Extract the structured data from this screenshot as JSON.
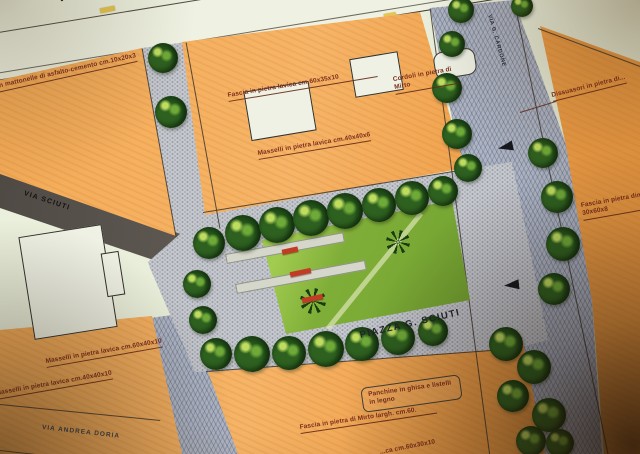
{
  "title": {
    "piazza": "PIAZZA G. SCIUTI"
  },
  "streets": {
    "top": "VIA F.",
    "left": "VIA SCIUTI",
    "bottom_left": "VIA ANDREA DORIA",
    "right_vertical": "VIA G. CARDONE"
  },
  "annotations": {
    "asfalto": "con mattonelle di asfalto-cemento cm.10x20x3",
    "fascia_lavica_top": "Fascia in pietra lavica cm.60x35x10",
    "cordoli_mirto": "Cordoli in pietra di Mirto",
    "masselli_40x40x6": "Masselli in pietra lavica cm.40x40x6",
    "dissuasori": "Dissuasori in pietra di...",
    "fascia_right": "Fascia in pietra dim. 30x60x8",
    "masselli_60x40x10": "Masselli in pietra lavica cm.60x40x10",
    "masselli_40x40x10": "Masselli in pietra lavica cm.40x40x10",
    "panchine": "Panchine in ghisa e listelli in legno",
    "fascia_mirto": "Fascia in pietra di Mirto largh. cm.60.",
    "fascia_bottom_partial": "...ca cm.60x30x10"
  },
  "colors": {
    "orange_block": "#f2a452",
    "paving_grey": "#c7c8cc",
    "road_blue_grey": "#aeb5c4",
    "road_dark": "#5e5850",
    "lawn_green": "#7fae38",
    "tree_green": "#1b4314",
    "bench_red": "#c23b24",
    "label_red": "#7c2f1d",
    "ink": "#2a2822"
  },
  "features": {
    "trees": [
      {
        "x": 163,
        "y": 58,
        "d": 30
      },
      {
        "x": 171,
        "y": 112,
        "d": 32
      },
      {
        "x": 461,
        "y": 10,
        "d": 26
      },
      {
        "x": 522,
        "y": 6,
        "d": 22
      },
      {
        "x": 452,
        "y": 44,
        "d": 26
      },
      {
        "x": 447,
        "y": 88,
        "d": 30
      },
      {
        "x": 457,
        "y": 134,
        "d": 30
      },
      {
        "x": 468,
        "y": 168,
        "d": 28
      },
      {
        "x": 209,
        "y": 243,
        "d": 32
      },
      {
        "x": 243,
        "y": 233,
        "d": 36
      },
      {
        "x": 277,
        "y": 225,
        "d": 36
      },
      {
        "x": 311,
        "y": 218,
        "d": 36
      },
      {
        "x": 345,
        "y": 211,
        "d": 36
      },
      {
        "x": 379,
        "y": 205,
        "d": 34
      },
      {
        "x": 412,
        "y": 198,
        "d": 34
      },
      {
        "x": 443,
        "y": 191,
        "d": 30
      },
      {
        "x": 543,
        "y": 153,
        "d": 30
      },
      {
        "x": 557,
        "y": 197,
        "d": 32
      },
      {
        "x": 563,
        "y": 244,
        "d": 34
      },
      {
        "x": 554,
        "y": 289,
        "d": 32
      },
      {
        "x": 197,
        "y": 284,
        "d": 28
      },
      {
        "x": 203,
        "y": 320,
        "d": 28
      },
      {
        "x": 216,
        "y": 354,
        "d": 32
      },
      {
        "x": 252,
        "y": 354,
        "d": 36
      },
      {
        "x": 289,
        "y": 353,
        "d": 34
      },
      {
        "x": 326,
        "y": 349,
        "d": 36
      },
      {
        "x": 362,
        "y": 344,
        "d": 34
      },
      {
        "x": 398,
        "y": 338,
        "d": 34
      },
      {
        "x": 433,
        "y": 331,
        "d": 30
      },
      {
        "x": 506,
        "y": 344,
        "d": 34
      },
      {
        "x": 534,
        "y": 367,
        "d": 34
      },
      {
        "x": 513,
        "y": 396,
        "d": 32
      },
      {
        "x": 549,
        "y": 415,
        "d": 34
      },
      {
        "x": 531,
        "y": 441,
        "d": 30
      },
      {
        "x": 560,
        "y": 443,
        "d": 28
      }
    ],
    "arrows": [
      {
        "x": 498,
        "y": 142,
        "rot": -12
      },
      {
        "x": 504,
        "y": 280,
        "rot": -6
      }
    ],
    "benches": [
      {
        "x": 282,
        "y": 248,
        "w": 16,
        "rot": -12
      },
      {
        "x": 290,
        "y": 270,
        "w": 21,
        "rot": -12
      },
      {
        "x": 302,
        "y": 296,
        "w": 21,
        "rot": -12
      }
    ]
  }
}
